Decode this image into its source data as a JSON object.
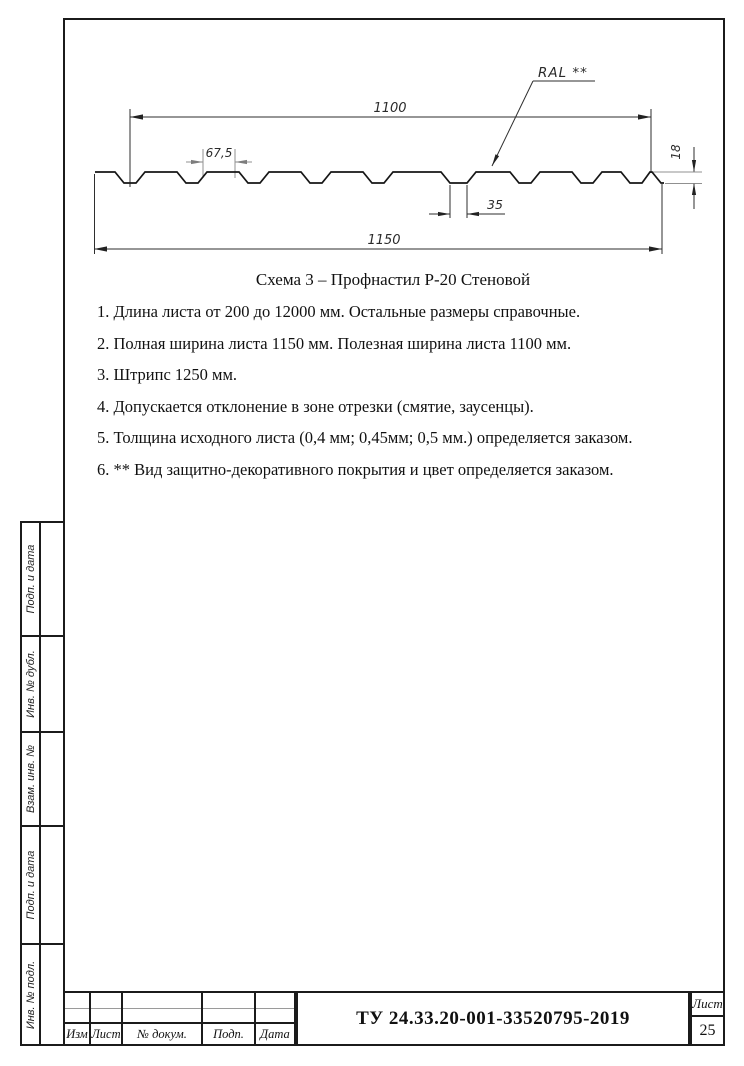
{
  "caption": "Схема 3 – Профнастил Р-20 Стеновой",
  "drawing": {
    "dims": {
      "useful_width": "1100",
      "pitch": "67,5",
      "height": "18",
      "rib_width": "35",
      "full_width": "1150"
    },
    "leader": "RAL **"
  },
  "notes": [
    "1. Длина листа от 200 до 12000 мм. Остальные размеры справочные.",
    "2. Полная ширина листа 1150 мм. Полезная ширина листа 1100 мм.",
    "3. Штрипс 1250 мм.",
    "4. Допускается отклонение в зоне отрезки (смятие, заусенцы).",
    "5. Толщина исходного листа (0,4 мм; 0,45мм; 0,5 мм.) определяется заказом.",
    "6. ** Вид защитно-декоративного покрытия и цвет определяется заказом."
  ],
  "sidebar": {
    "items": [
      {
        "label": "Подп. и дата"
      },
      {
        "label": "Инв. № дубл."
      },
      {
        "label": "Взам. инв. №"
      },
      {
        "label": "Подп. и дата"
      },
      {
        "label": "Инв. № подл."
      }
    ]
  },
  "title_block": {
    "headers": [
      "Изм",
      "Лист",
      "№ докум.",
      "Подп.",
      "Дата"
    ],
    "document_number": "ТУ 24.33.20-001-33520795-2019",
    "sheet_label": "Лист",
    "sheet_number": "25"
  },
  "colors": {
    "line": "#1b1b1b",
    "thin": "#909090"
  }
}
